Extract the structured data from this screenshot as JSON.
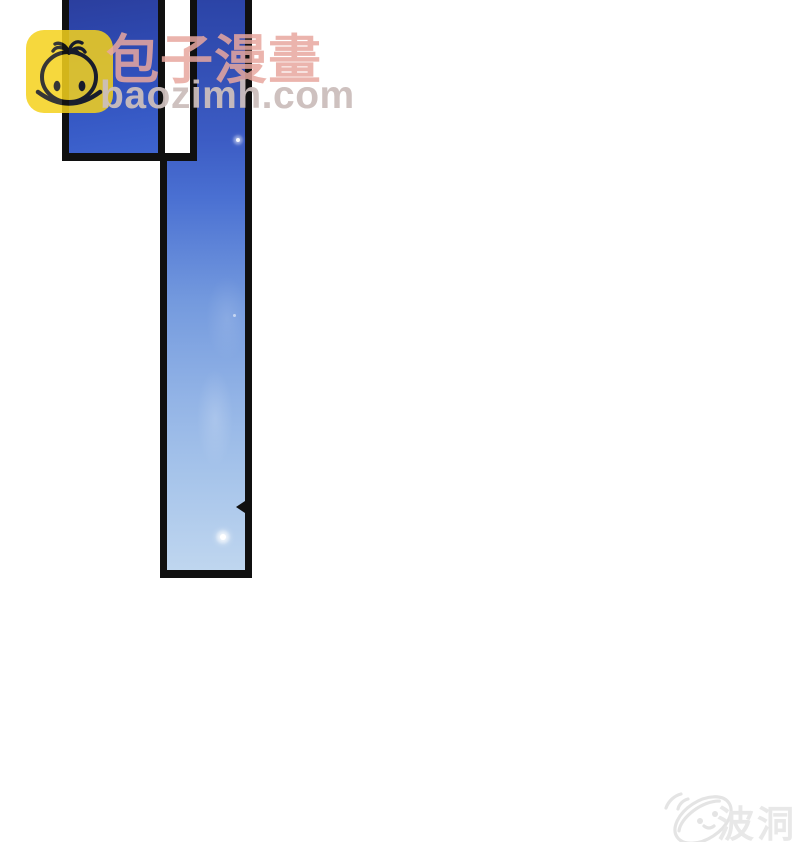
{
  "page": {
    "kind": "comic-reader-page",
    "background_color": "#ffffff"
  },
  "comic": {
    "panel_border_color": "#101010",
    "panels": [
      {
        "name": "top-left-panel",
        "content": "dark blue sky",
        "fill_top_color": "#2a3c9a",
        "fill_bottom_color": "#3e64cf"
      },
      {
        "name": "tall-right-panel",
        "content": "sky gradient with star sparkles",
        "fill_top_color": "#2c45a8",
        "fill_bottom_color": "#bfd6ef",
        "sparkle_color": "#ffffff"
      }
    ]
  },
  "watermark_baozimh": {
    "site_name": "包子漫畫",
    "site_url": "baozimh.com",
    "logo_icon": "baozi-bun-app-icon",
    "logo_background_color": "#f5d21c",
    "logo_line_color": "#141414",
    "title_color": "#e7a79f",
    "url_color": "#cbbebc"
  },
  "watermark_bodong": {
    "label": "波洞",
    "logo_icon": "bodong-oval-creature-logo",
    "color": "#e8e8e8"
  }
}
